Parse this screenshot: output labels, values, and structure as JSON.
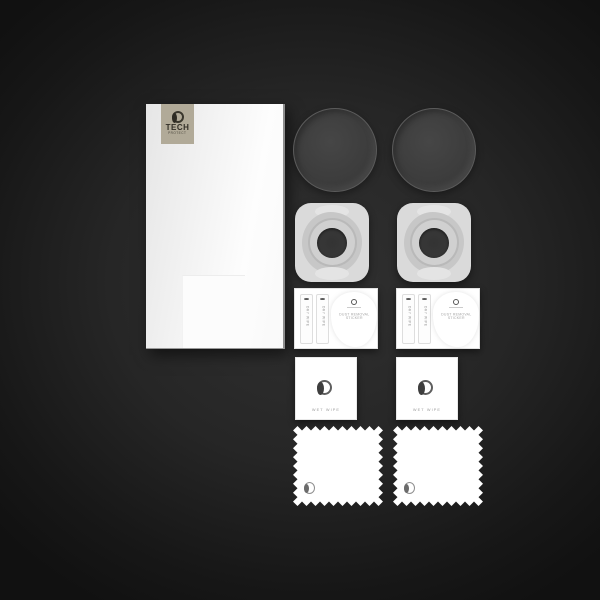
{
  "scene": {
    "description": "Tech-Protect camera lens glass protection kit flat lay on dark background"
  },
  "brand": {
    "logo_text": "TECH",
    "logo_subtext": "PROTECT"
  },
  "box": {
    "logo_text": "TECH",
    "logo_subtext": "PROTECT"
  },
  "accessory_card": {
    "strip_label": "DRY WIPE",
    "sticker_line1": "DUST REMOVAL",
    "sticker_line2": "STICKER"
  },
  "wet_wipe": {
    "label": "WET WIPE"
  },
  "counts": {
    "glass_discs": 2,
    "installation_frames": 2,
    "accessory_cards": 2,
    "wet_wipes": 2,
    "microfiber_cloths": 2
  },
  "colors": {
    "background_center": "#313131",
    "background_edge": "#111111",
    "box_face": "#f3f3f3",
    "logo_square": "#b1aa98",
    "logo_ink": "#332f27",
    "glass_disc": "#3d3d3d",
    "frame_body": "#dadada",
    "frame_blob": "#c7c7c7",
    "frame_hole": "#333333",
    "paper_white": "#ffffff",
    "muted_text": "#9b9b9b"
  }
}
